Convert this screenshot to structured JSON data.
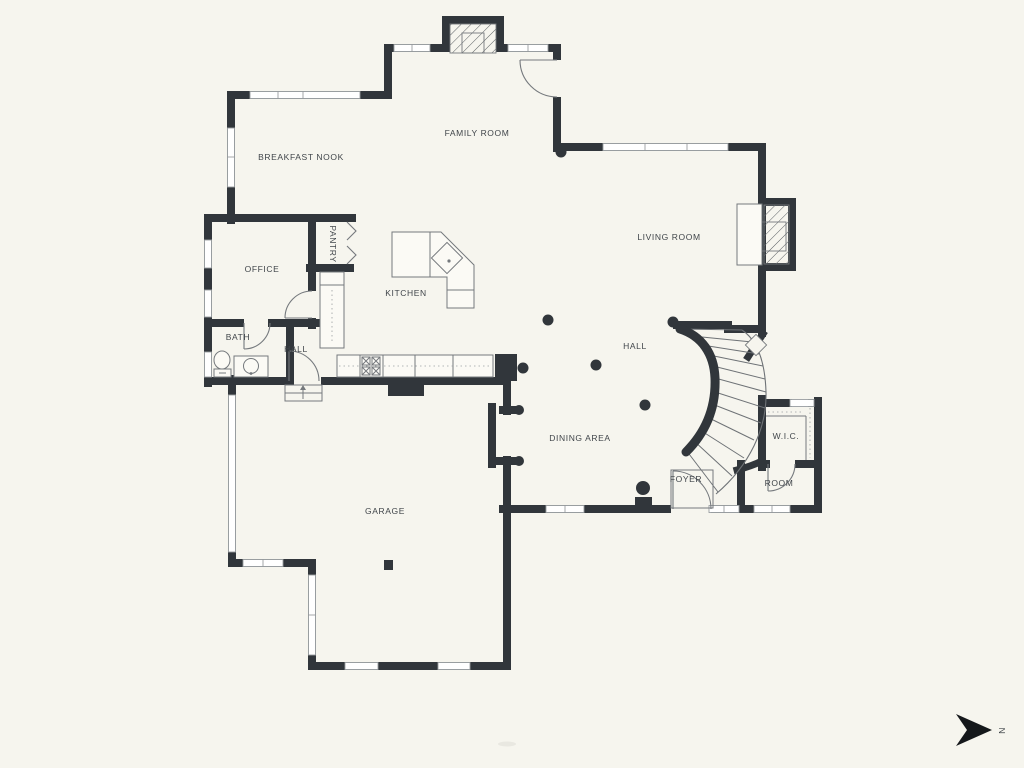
{
  "plan": {
    "type": "residential-floor-plan",
    "rooms": [
      {
        "id": "family-room",
        "label": "FAMILY ROOM"
      },
      {
        "id": "breakfast-nook",
        "label": "BREAKFAST NOOK"
      },
      {
        "id": "living-room",
        "label": "LIVING ROOM"
      },
      {
        "id": "office",
        "label": "OFFICE"
      },
      {
        "id": "pantry",
        "label": "PANTRY"
      },
      {
        "id": "kitchen",
        "label": "KITCHEN"
      },
      {
        "id": "bath",
        "label": "BATH"
      },
      {
        "id": "hall-small",
        "label": "HALL"
      },
      {
        "id": "hall",
        "label": "HALL"
      },
      {
        "id": "dining-area",
        "label": "DINING AREA"
      },
      {
        "id": "garage",
        "label": "GARAGE"
      },
      {
        "id": "foyer",
        "label": "FOYER"
      },
      {
        "id": "wic",
        "label": "W.I.C."
      },
      {
        "id": "room",
        "label": "ROOM"
      }
    ],
    "compass": {
      "label": "N",
      "direction": "right"
    },
    "icons": [
      "north-arrow-icon",
      "fireplace-hatch",
      "curved-staircase",
      "toilet-icon",
      "sink-icon",
      "stove-burners-icon"
    ],
    "colors": {
      "background": "#f6f5ee",
      "wall": "#31363b",
      "fixture_line": "#75797d",
      "window_frame": "#9a9ea1",
      "label_text": "#40454a"
    }
  }
}
